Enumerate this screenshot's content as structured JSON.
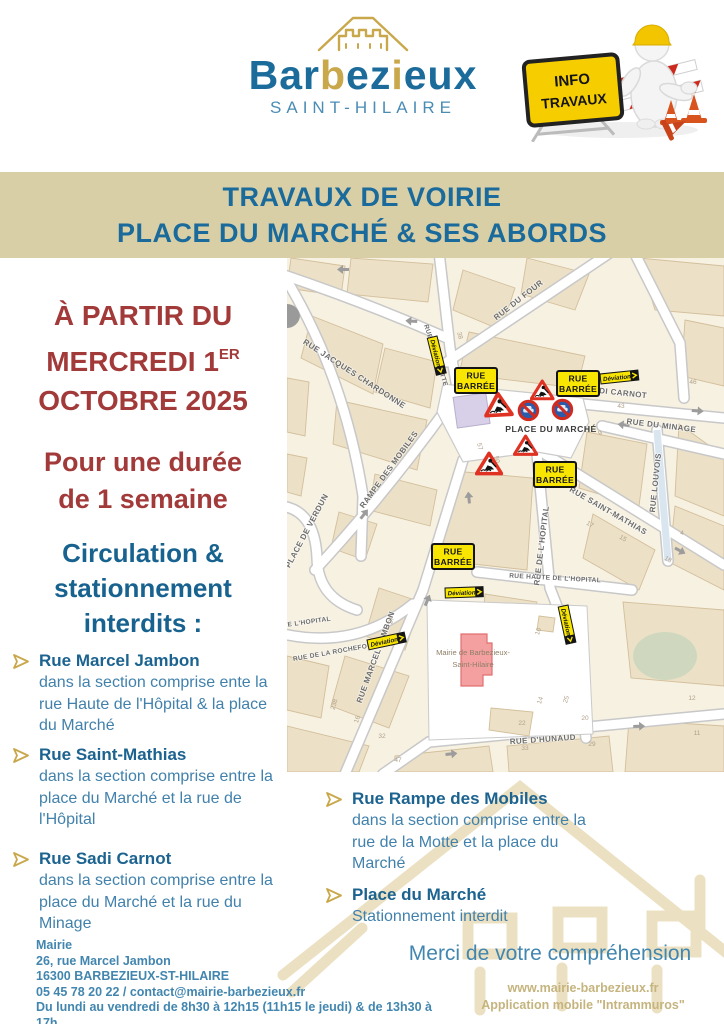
{
  "header": {
    "brand_p1": "Bar",
    "brand_p2": "b",
    "brand_p3": "ez",
    "brand_p4": "i",
    "brand_p5": "eux",
    "subtitle": "SAINT-HILAIRE",
    "sign_line1": "INFO",
    "sign_line2": "TRAVAUX"
  },
  "banner": {
    "line1": "TRAVAUX DE VOIRIE",
    "line2": "PLACE DU MARCHÉ & SES ABORDS"
  },
  "left": {
    "date_line1": "À PARTIR DU",
    "date_line2": "MERCREDI 1",
    "date_sup": "ER",
    "date_line3": "OCTOBRE 2025",
    "duration_line1": "Pour une durée",
    "duration_line2": "de 1 semaine",
    "heading_line1": "Circulation &",
    "heading_line2": "stationnement",
    "heading_line3": "interdits :"
  },
  "restrictions": [
    {
      "street": "Rue Marcel Jambon",
      "detail": "dans la section comprise ente la rue Haute de l'Hôpital & la place du Marché"
    },
    {
      "street": "Rue Saint-Mathias",
      "detail": "dans la section comprise entre la place du Marché et la rue de l'Hôpital"
    },
    {
      "street": "Rue Sadi Carnot",
      "detail": "dans la section comprise entre la place du Marché et la rue du Minage"
    },
    {
      "street": "Rue Rampe des Mobiles",
      "detail": "dans la section comprise entre la rue de la Motte et la place du Marché"
    },
    {
      "street": "Place du Marché",
      "detail": "Stationnement interdit"
    }
  ],
  "map": {
    "streets": {
      "four": "RUE DU FOUR",
      "chardonne": "RUE JACQUES CHARDONNE",
      "motte": "RUE DE LA MOTTE",
      "sadi": "SADI CARNOT",
      "minage": "RUE DU MINAGE",
      "louvois": "RUE LOUVOIS",
      "mathias": "RUE SAINT-MATHIAS",
      "hopital": "RUE DE L'HOPITAL",
      "haute": "RUE HAUTE DE L'HOPITAL",
      "haute2": "DE L'HOPITAL",
      "rampe": "RAMPE DES MOBILES",
      "verdun": "PLACE DE VERDUN",
      "jambon": "RUE MARCEL JAMBON",
      "rochefoucauld": "RUE DE LA ROCHEFOUCAULD",
      "hunaud": "RUE D'HUNAUD",
      "place": "PLACE DU MARCHÉ"
    },
    "mairie": {
      "l1": "Mairie de Barbezieux-",
      "l2": "Saint-Hilaire"
    },
    "signs": {
      "rb1": "RUE",
      "rb2": "BARRÉE",
      "dev": "Déviation"
    },
    "numbers": [
      "38",
      "46",
      "43",
      "9",
      "57",
      "50",
      "17",
      "15",
      "18",
      "27",
      "16",
      "32",
      "47",
      "238",
      "22",
      "33",
      "29",
      "20",
      "25",
      "14",
      "10",
      "11",
      "12",
      "4"
    ]
  },
  "footer": {
    "address": [
      "Mairie",
      "26, rue Marcel Jambon",
      "16300 BARBEZIEUX-ST-HILAIRE",
      "05 45 78 20 22 / contact@mairie-barbezieux.fr",
      "Du lundi au vendredi de 8h30 à 12h15 (11h15 le jeudi) & de 13h30 à 17h"
    ],
    "thanks": "Merci de votre compréhension",
    "website": "www.mairie-barbezieux.fr",
    "app": "Application mobile \"Intrammuros\""
  },
  "colors": {
    "banner_bg": "#d8cfa6",
    "title_blue": "#1a6a9b",
    "alert_red": "#a23a3a",
    "text_blue": "#4181ab",
    "gold": "#c9a84c",
    "sign_yellow": "#f8e602",
    "sign_red": "#e03222"
  }
}
